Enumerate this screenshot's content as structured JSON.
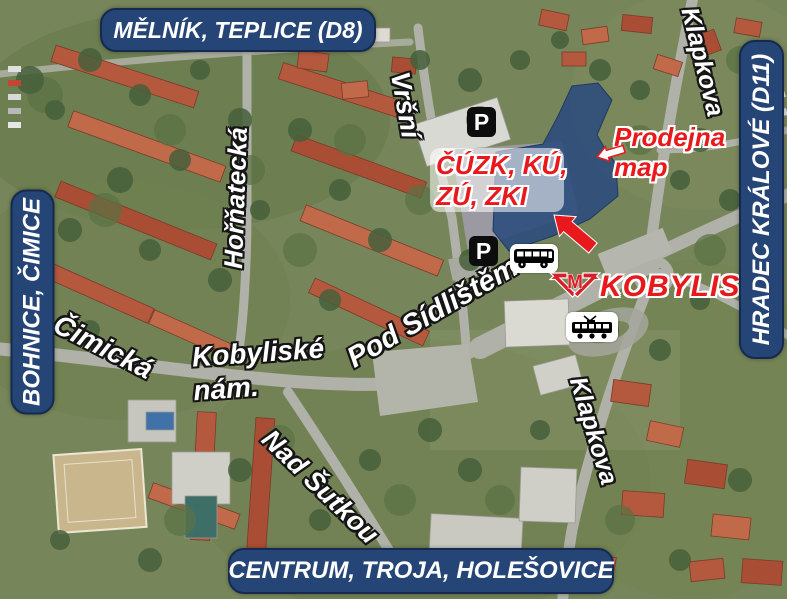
{
  "signs": {
    "top": "MĚLNÍK, TEPLICE (D8)",
    "left": "BOHNICE, ČIMICE",
    "right": "HRADEC KRÁLOVÉ (D11)",
    "bottom": "CENTRUM, TROJA, HOLEŠOVICE"
  },
  "streets": {
    "vrsni": "Vršní",
    "hornatecka": "Hořňatecká",
    "cimicka": "Čimická",
    "kobyliske_line1": "Kobyliské",
    "kobyliske_line2": "nám.",
    "pod_sidlistem": "Pod Sídlištěm",
    "nad_sutkou": "Nad Šutkou",
    "klapkova_north": "Klapkova",
    "klapkova_south": "Klapkova"
  },
  "labels": {
    "office_line1": "ČÚZK, KÚ,",
    "office_line2": "ZÚ, ZKI",
    "map_shop_line1": "Prodejna",
    "map_shop_line2": "map",
    "metro_station": "KOBYLISY"
  },
  "icons": {
    "parking": "P",
    "metro_logo": "M"
  },
  "colors": {
    "sign_navy": "#254577",
    "label_red": "#e8191c",
    "street_white": "#ffffff",
    "highlight_blue": "#2e4d7c"
  }
}
